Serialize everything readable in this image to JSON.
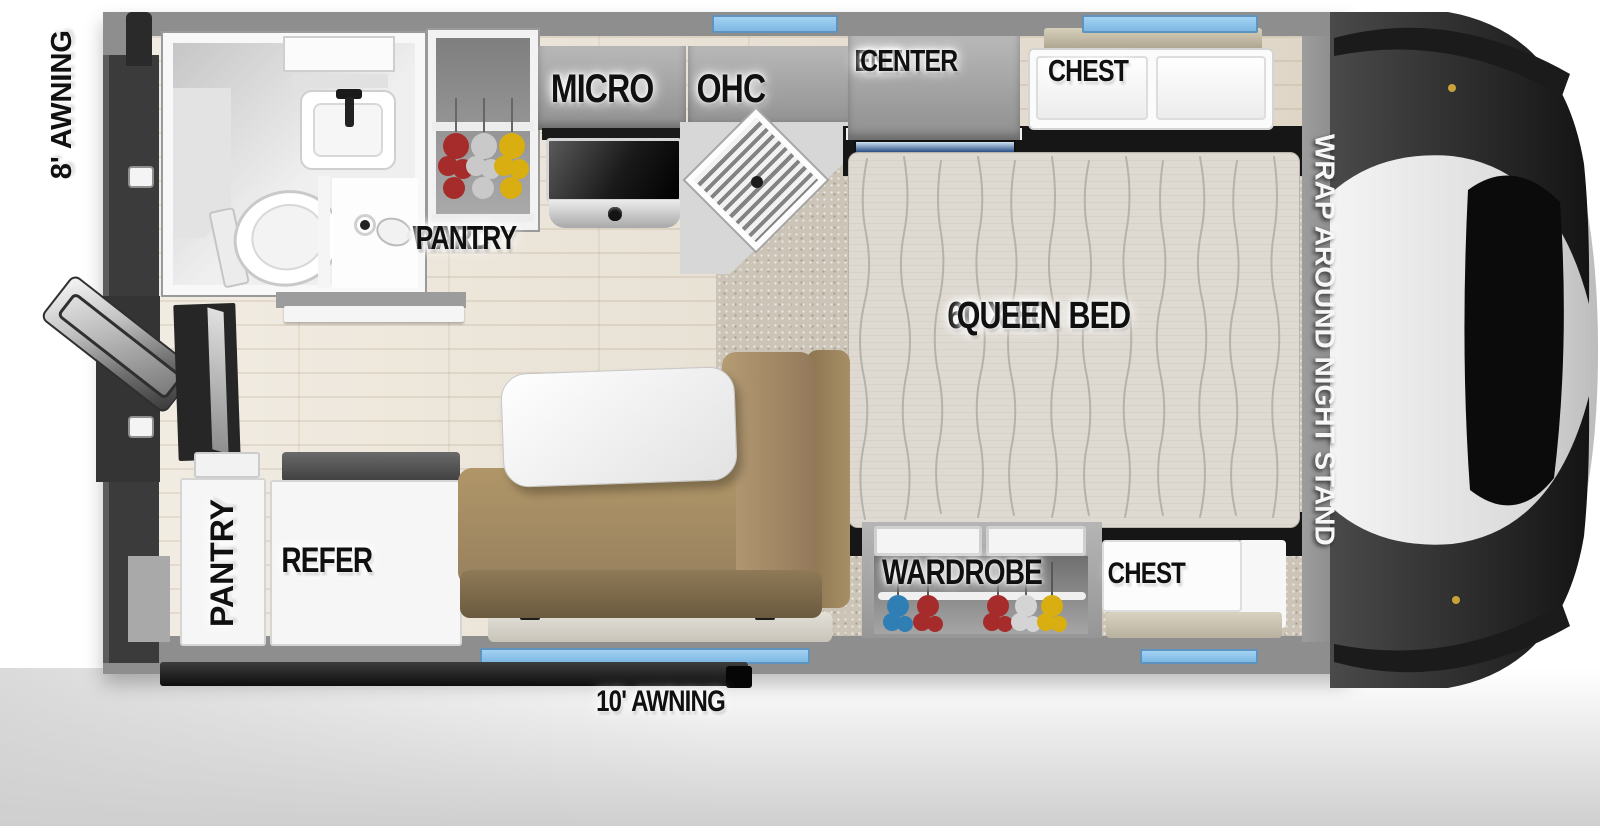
{
  "floorplan": {
    "awning_left": "8' AWNING",
    "awning_bottom": "10' AWNING",
    "ward_pantry_line1": "WARD",
    "ward_pantry_line2": "PANTRY",
    "micro": "MICRO",
    "ohc": "OHC",
    "ent_line1": "ENT.",
    "ent_line2": "CENTER",
    "chest_front": "CHEST",
    "bed_line1": "60 X 80",
    "bed_line2": "QUEEN BED",
    "night_stand": "WRAP AROUND NIGHT STAND",
    "wardrobe": "WARDROBE",
    "chest_rear": "CHEST",
    "pantry": "PANTRY",
    "refer": "REFER"
  },
  "colors": {
    "window_blue": "#8cc3ec",
    "wall_gray": "#8e8e8e",
    "sofa_tan": "#a68e67",
    "carpet_beige": "#ccc5b7",
    "wood_floor": "#e8dfcf",
    "label_text": "#111111",
    "night_stand_text": "#f5f5f5"
  }
}
